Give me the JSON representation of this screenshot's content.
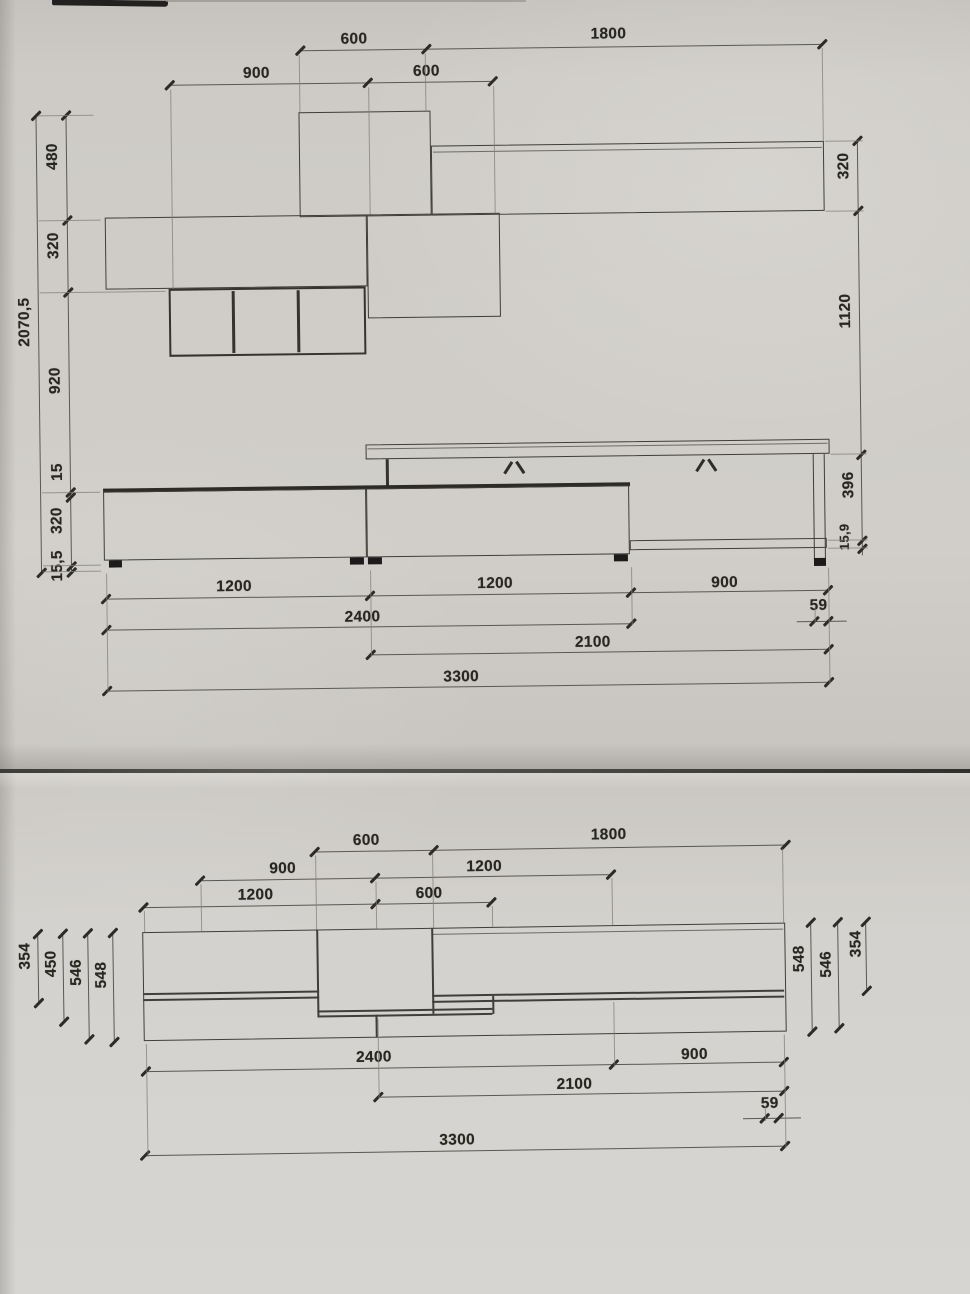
{
  "document": {
    "kind": "photographed furniture technical drawing",
    "views": [
      "front elevation",
      "top plan"
    ]
  },
  "colors": {
    "paper": "#cdcac6",
    "ink": "#3f3e3a",
    "dim_ink": "#5a5853",
    "fold": "#3e3c38"
  },
  "elevation": {
    "top_dims": [
      "600",
      "1800",
      "900",
      "600"
    ],
    "left_total": "2070,5",
    "left_chain": [
      "480",
      "320",
      "920",
      "15",
      "320",
      "15,5"
    ],
    "right_chain": [
      "320",
      "1120",
      "396",
      "15,9"
    ],
    "bottom_dims": [
      "1200",
      "1200",
      "900",
      "2400",
      "59",
      "2100",
      "3300"
    ]
  },
  "plan": {
    "top_dims": [
      "600",
      "1800",
      "900",
      "1200",
      "1200",
      "600"
    ],
    "left_dims": [
      "354",
      "450",
      "546",
      "548"
    ],
    "right_dims": [
      "548",
      "546",
      "354"
    ],
    "bottom_dims": [
      "2400",
      "900",
      "2100",
      "59",
      "3300"
    ]
  }
}
